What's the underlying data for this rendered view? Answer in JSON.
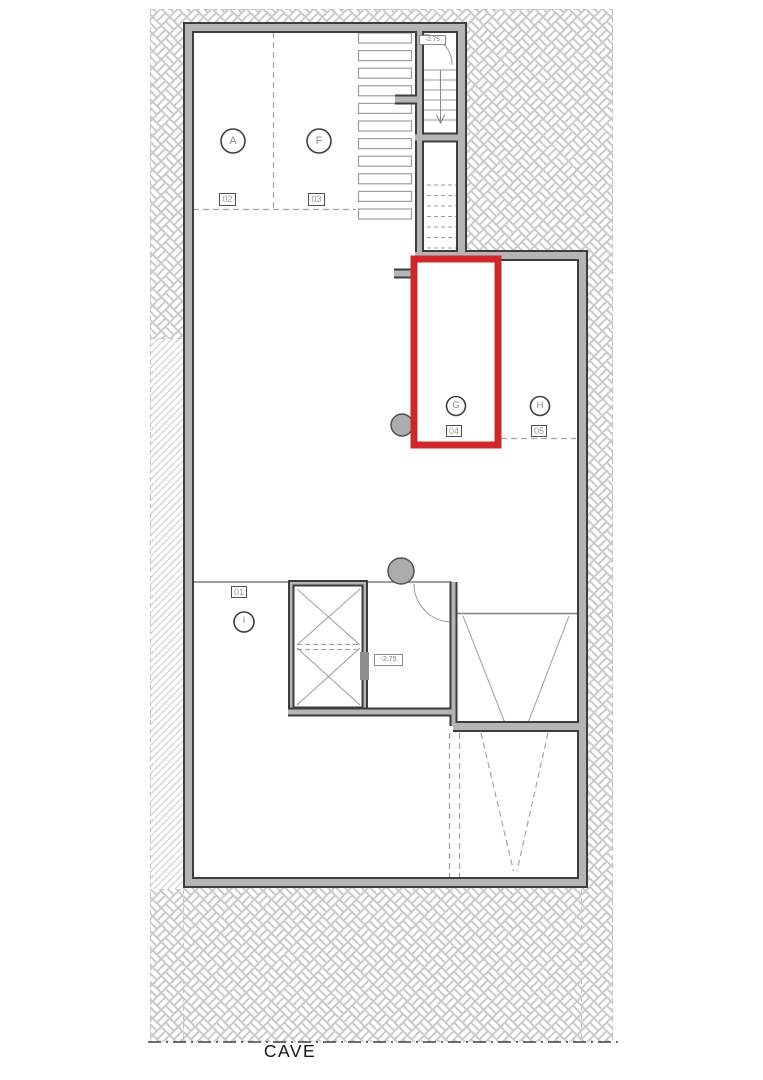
{
  "drawing": {
    "title": "CAVE",
    "highlight_color": "#d0272b",
    "wall_gray": "#b5b5b5",
    "wall_dark": "#3d3d3d"
  },
  "rooms": [
    {
      "letter": "A",
      "number": "02"
    },
    {
      "letter": "F",
      "number": "03"
    },
    {
      "letter": "G",
      "number": "04"
    },
    {
      "letter": "H",
      "number": "05"
    },
    {
      "letter": "I",
      "number": "01"
    }
  ],
  "elevations": {
    "stair_landing": "-2.75",
    "basement_hall": "-2.75"
  }
}
